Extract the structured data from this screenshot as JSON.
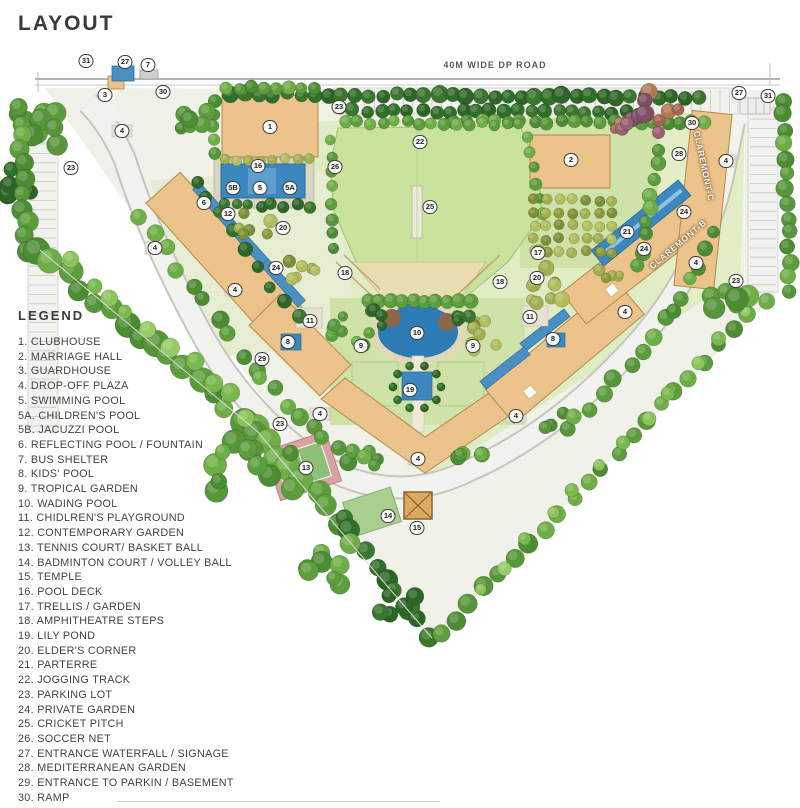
{
  "title": "LAYOUT",
  "legend": {
    "heading": "LEGEND",
    "items": [
      {
        "num": "1",
        "label": "CLUBHOUSE"
      },
      {
        "num": "2",
        "label": "MARRIAGE HALL"
      },
      {
        "num": "3",
        "label": "GUARDHOUSE"
      },
      {
        "num": "4",
        "label": "DROP-OFF PLAZA"
      },
      {
        "num": "5",
        "label": "SWIMMING POOL"
      },
      {
        "num": "5A",
        "label": "CHILDREN'S POOL"
      },
      {
        "num": "5B",
        "label": "JACUZZI POOL"
      },
      {
        "num": "6",
        "label": "REFLECTING POOL / FOUNTAIN"
      },
      {
        "num": "7",
        "label": "BUS SHELTER"
      },
      {
        "num": "8",
        "label": "KIDS' POOL"
      },
      {
        "num": "9",
        "label": "TROPICAL GARDEN"
      },
      {
        "num": "10",
        "label": "WADING POOL"
      },
      {
        "num": "11",
        "label": "CHIDLREN'S PLAYGROUND"
      },
      {
        "num": "12",
        "label": "CONTEMPORARY GARDEN"
      },
      {
        "num": "13",
        "label": "TENNIS COURT/ BASKET BALL"
      },
      {
        "num": "14",
        "label": "BADMINTON COURT / VOLLEY BALL"
      },
      {
        "num": "15",
        "label": "TEMPLE"
      },
      {
        "num": "16",
        "label": "POOL DECK"
      },
      {
        "num": "17",
        "label": "TRELLIS / GARDEN"
      },
      {
        "num": "18",
        "label": "AMPHITHEATRE STEPS"
      },
      {
        "num": "19",
        "label": "LILY POND"
      },
      {
        "num": "20",
        "label": "ELDER'S CORNER"
      },
      {
        "num": "21",
        "label": "PARTERRE"
      },
      {
        "num": "22",
        "label": "JOGGING TRACK"
      },
      {
        "num": "23",
        "label": "PARKING LOT"
      },
      {
        "num": "24",
        "label": "PRIVATE GARDEN"
      },
      {
        "num": "25",
        "label": "CRICKET PITCH"
      },
      {
        "num": "26",
        "label": "SOCCER NET"
      },
      {
        "num": "27",
        "label": "ENTRANCE WATERFALL / SIGNAGE"
      },
      {
        "num": "28",
        "label": "MEDITERRANEAN GARDEN"
      },
      {
        "num": "29",
        "label": "ENTRANCE TO PARKIN / BASEMENT"
      },
      {
        "num": "30",
        "label": "RAMP"
      },
      {
        "num": "31",
        "label": "MAIN ENTRANCE"
      }
    ]
  },
  "map": {
    "road_label": "40M WIDE DP ROAD",
    "building_labels": [
      {
        "text": "CLAREMONT-C",
        "x": 704,
        "y": 166,
        "rotate": 78
      },
      {
        "text": "CLAREMONT-B",
        "x": 678,
        "y": 244,
        "rotate": -40
      }
    ],
    "markers": [
      {
        "n": "31",
        "x": 86,
        "y": 61
      },
      {
        "n": "27",
        "x": 125,
        "y": 62
      },
      {
        "n": "7",
        "x": 148,
        "y": 65
      },
      {
        "n": "3",
        "x": 105,
        "y": 95
      },
      {
        "n": "30",
        "x": 163,
        "y": 92
      },
      {
        "n": "4",
        "x": 122,
        "y": 131
      },
      {
        "n": "23",
        "x": 71,
        "y": 168
      },
      {
        "n": "1",
        "x": 270,
        "y": 127
      },
      {
        "n": "23",
        "x": 339,
        "y": 107
      },
      {
        "n": "22",
        "x": 420,
        "y": 142
      },
      {
        "n": "26",
        "x": 335,
        "y": 167
      },
      {
        "n": "25",
        "x": 430,
        "y": 207
      },
      {
        "n": "5B",
        "x": 233,
        "y": 188
      },
      {
        "n": "5",
        "x": 260,
        "y": 188
      },
      {
        "n": "5A",
        "x": 290,
        "y": 188
      },
      {
        "n": "16",
        "x": 258,
        "y": 166
      },
      {
        "n": "6",
        "x": 204,
        "y": 203
      },
      {
        "n": "12",
        "x": 228,
        "y": 214
      },
      {
        "n": "20",
        "x": 283,
        "y": 228
      },
      {
        "n": "4",
        "x": 155,
        "y": 248
      },
      {
        "n": "24",
        "x": 276,
        "y": 268
      },
      {
        "n": "4",
        "x": 235,
        "y": 290
      },
      {
        "n": "29",
        "x": 262,
        "y": 359
      },
      {
        "n": "8",
        "x": 288,
        "y": 342
      },
      {
        "n": "11",
        "x": 310,
        "y": 321
      },
      {
        "n": "9",
        "x": 361,
        "y": 346
      },
      {
        "n": "18",
        "x": 345,
        "y": 273
      },
      {
        "n": "23",
        "x": 280,
        "y": 424
      },
      {
        "n": "13",
        "x": 306,
        "y": 468
      },
      {
        "n": "4",
        "x": 320,
        "y": 414
      },
      {
        "n": "4",
        "x": 418,
        "y": 459
      },
      {
        "n": "14",
        "x": 388,
        "y": 516
      },
      {
        "n": "15",
        "x": 417,
        "y": 528
      },
      {
        "n": "10",
        "x": 417,
        "y": 333
      },
      {
        "n": "19",
        "x": 410,
        "y": 390
      },
      {
        "n": "18",
        "x": 500,
        "y": 282
      },
      {
        "n": "17",
        "x": 538,
        "y": 253
      },
      {
        "n": "20",
        "x": 537,
        "y": 278
      },
      {
        "n": "11",
        "x": 530,
        "y": 317
      },
      {
        "n": "8",
        "x": 553,
        "y": 339
      },
      {
        "n": "9",
        "x": 473,
        "y": 346
      },
      {
        "n": "4",
        "x": 516,
        "y": 416
      },
      {
        "n": "4",
        "x": 625,
        "y": 312
      },
      {
        "n": "2",
        "x": 571,
        "y": 160
      },
      {
        "n": "28",
        "x": 679,
        "y": 154
      },
      {
        "n": "30",
        "x": 692,
        "y": 123
      },
      {
        "n": "27",
        "x": 739,
        "y": 93
      },
      {
        "n": "31",
        "x": 768,
        "y": 96
      },
      {
        "n": "4",
        "x": 726,
        "y": 161
      },
      {
        "n": "24",
        "x": 684,
        "y": 212
      },
      {
        "n": "21",
        "x": 627,
        "y": 232
      },
      {
        "n": "24",
        "x": 644,
        "y": 249
      },
      {
        "n": "4",
        "x": 696,
        "y": 263
      },
      {
        "n": "23",
        "x": 736,
        "y": 281
      }
    ]
  },
  "colors": {
    "field": "#c9e39c",
    "field_edge": "#9fc46f",
    "lawn": "#cfe3a8",
    "lawn_pale": "#e0ecc4",
    "building": "#ecc38a",
    "building_border": "#b08a4a",
    "water": "#3b87be",
    "water_border": "#2a6d9e",
    "road": "#f2f2ef",
    "road_edge": "#c6c6c1",
    "deck": "#d9d4c2",
    "sand": "#e2d7b8",
    "amphi": "#e9ddb2",
    "court_pink": "#d8a3a3",
    "court_green": "#8fbf77",
    "temple": "#dcaa60",
    "temple_border": "#8a6433",
    "marker_border": "#3d3d3d",
    "legend_text": "#424242"
  }
}
